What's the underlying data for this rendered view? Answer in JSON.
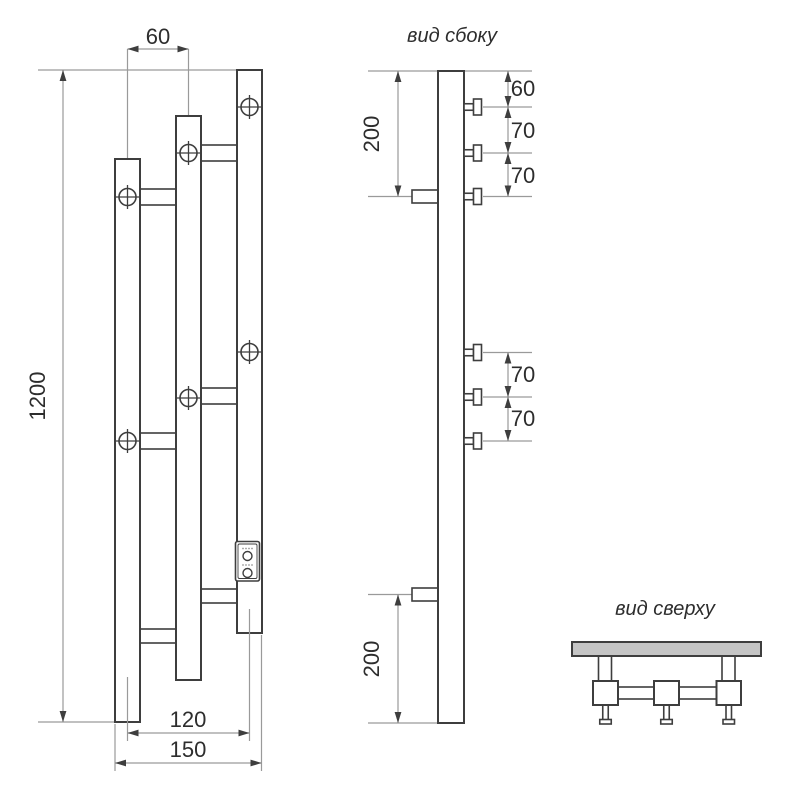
{
  "colors": {
    "outline": "#3e3e3e",
    "dim": "#9a9a9a",
    "text": "#2d2d2d",
    "wall_fill": "#c5c5c5",
    "bg": "#ffffff"
  },
  "front_view": {
    "dim_spacing": "60",
    "dim_height": "1200",
    "dim_centers": "120",
    "dim_width": "150"
  },
  "side_view": {
    "title": "вид сбоку",
    "dim_wall_top": "200",
    "dim_p1": "60",
    "dim_p2": "70",
    "dim_p3": "70",
    "dim_p4": "70",
    "dim_p5": "70",
    "dim_wall_bottom": "200"
  },
  "top_view": {
    "title": "вид сверху"
  }
}
